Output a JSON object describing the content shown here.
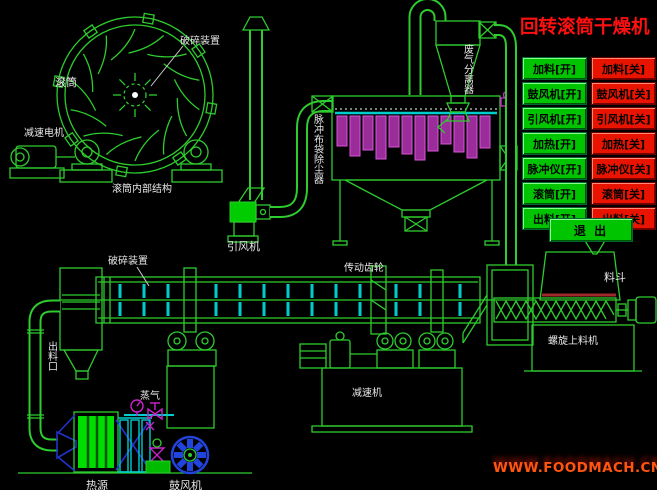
{
  "title": "回转滚筒干燥机",
  "watermark": "WWW.FOODMACH.CN",
  "control_panel": {
    "on_buttons": [
      "加料[开]",
      "鼓风机[开]",
      "引风机[开]",
      "加热[开]",
      "脉冲仪[开]",
      "滚筒[开]",
      "出料[开]"
    ],
    "off_buttons": [
      "加料[关]",
      "鼓风机[关]",
      "引风机[关]",
      "加热[关]",
      "脉冲仪[关]",
      "滚筒[关]",
      "出料[关]"
    ],
    "exit_button": "退 出"
  },
  "diagram_labels": {
    "crusher_device_top": "破碎装置",
    "drum": "滚筒",
    "gear_motor": "减速电机",
    "drum_internal_structure": "滚筒内部结构",
    "pulse_bag_dust_collector": "脉冲布袋除尘器",
    "waste_gas_separator": "废气分离器",
    "induced_draft_fan": "引风机",
    "crusher_device_mid": "破碎装置",
    "drive_gear": "传动齿轮",
    "hopper": "料斗",
    "screw_feeder": "螺旋上料机",
    "reducer": "减速机",
    "discharge_outlet": "出料口",
    "steam": "蒸气",
    "heat_source": "热源",
    "blower": "鼓风机"
  },
  "colors": {
    "line_green": "#2ecc2e",
    "bright_green": "#00cc00",
    "cyan": "#00cccc",
    "magenta": "#cc22cc",
    "blue": "#2233cc",
    "title_red": "#ff1010",
    "button_green": "#00c400",
    "button_red": "#e81400",
    "watermark_orange": "#ff5511",
    "bag_fill": "#9b2d9b"
  }
}
